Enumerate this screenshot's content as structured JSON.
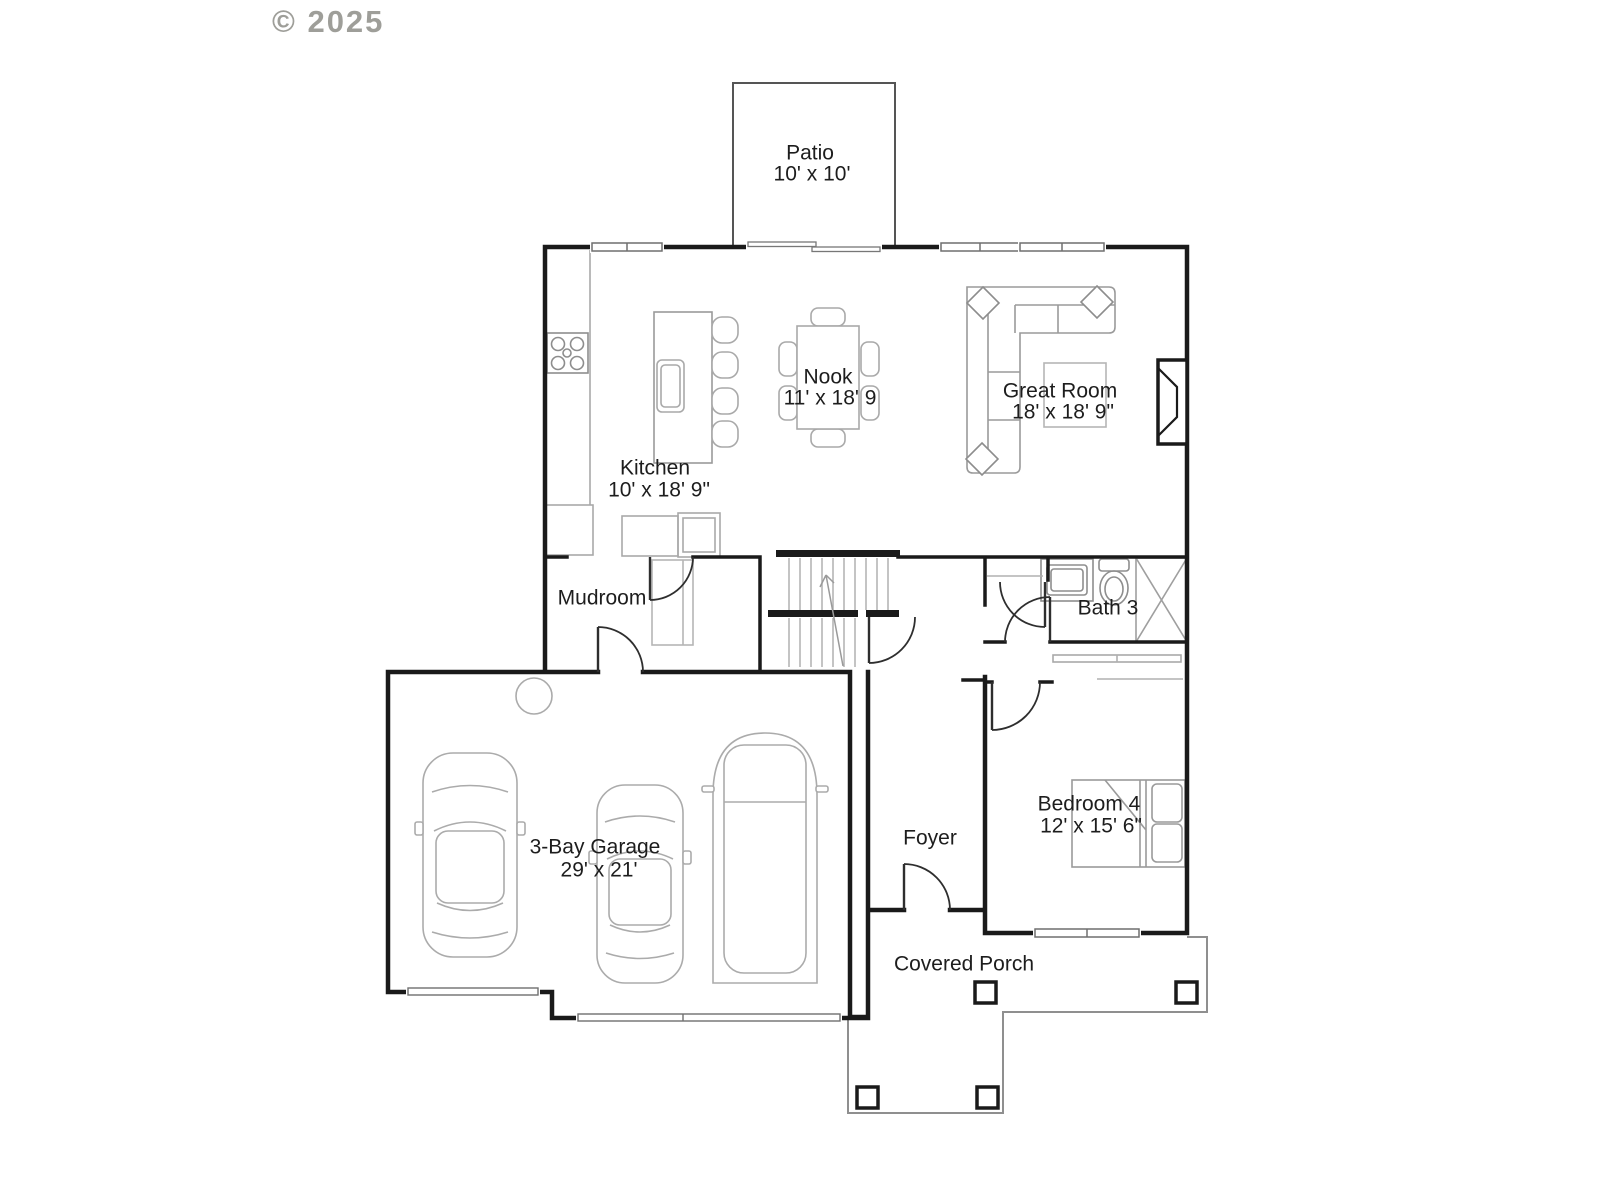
{
  "copyright": "© 2025",
  "labels": {
    "patio": {
      "name": "Patio",
      "dims": "10' x 10'"
    },
    "nook": {
      "name": "Nook",
      "dims": "11' x 18' 9"
    },
    "great_room": {
      "name": "Great Room",
      "dims": "18' x 18' 9\""
    },
    "kitchen": {
      "name": "Kitchen",
      "dims": "10' x 18' 9\""
    },
    "mudroom": {
      "name": "Mudroom"
    },
    "bath3": {
      "name": "Bath 3"
    },
    "garage": {
      "name": "3-Bay Garage",
      "dims": "29' x 21'"
    },
    "foyer": {
      "name": "Foyer"
    },
    "bedroom4": {
      "name": "Bedroom 4",
      "dims": "12' x 15' 6\""
    },
    "covered_porch": {
      "name": "Covered Porch"
    }
  },
  "colors": {
    "wall": "#1a1a1a",
    "furniture": "#a9a9a9",
    "window": "#6f6f6f",
    "porch_outline": "#8f8f8f",
    "label_text": "#1d1d1d",
    "copyright_text": "#8e8e88"
  }
}
